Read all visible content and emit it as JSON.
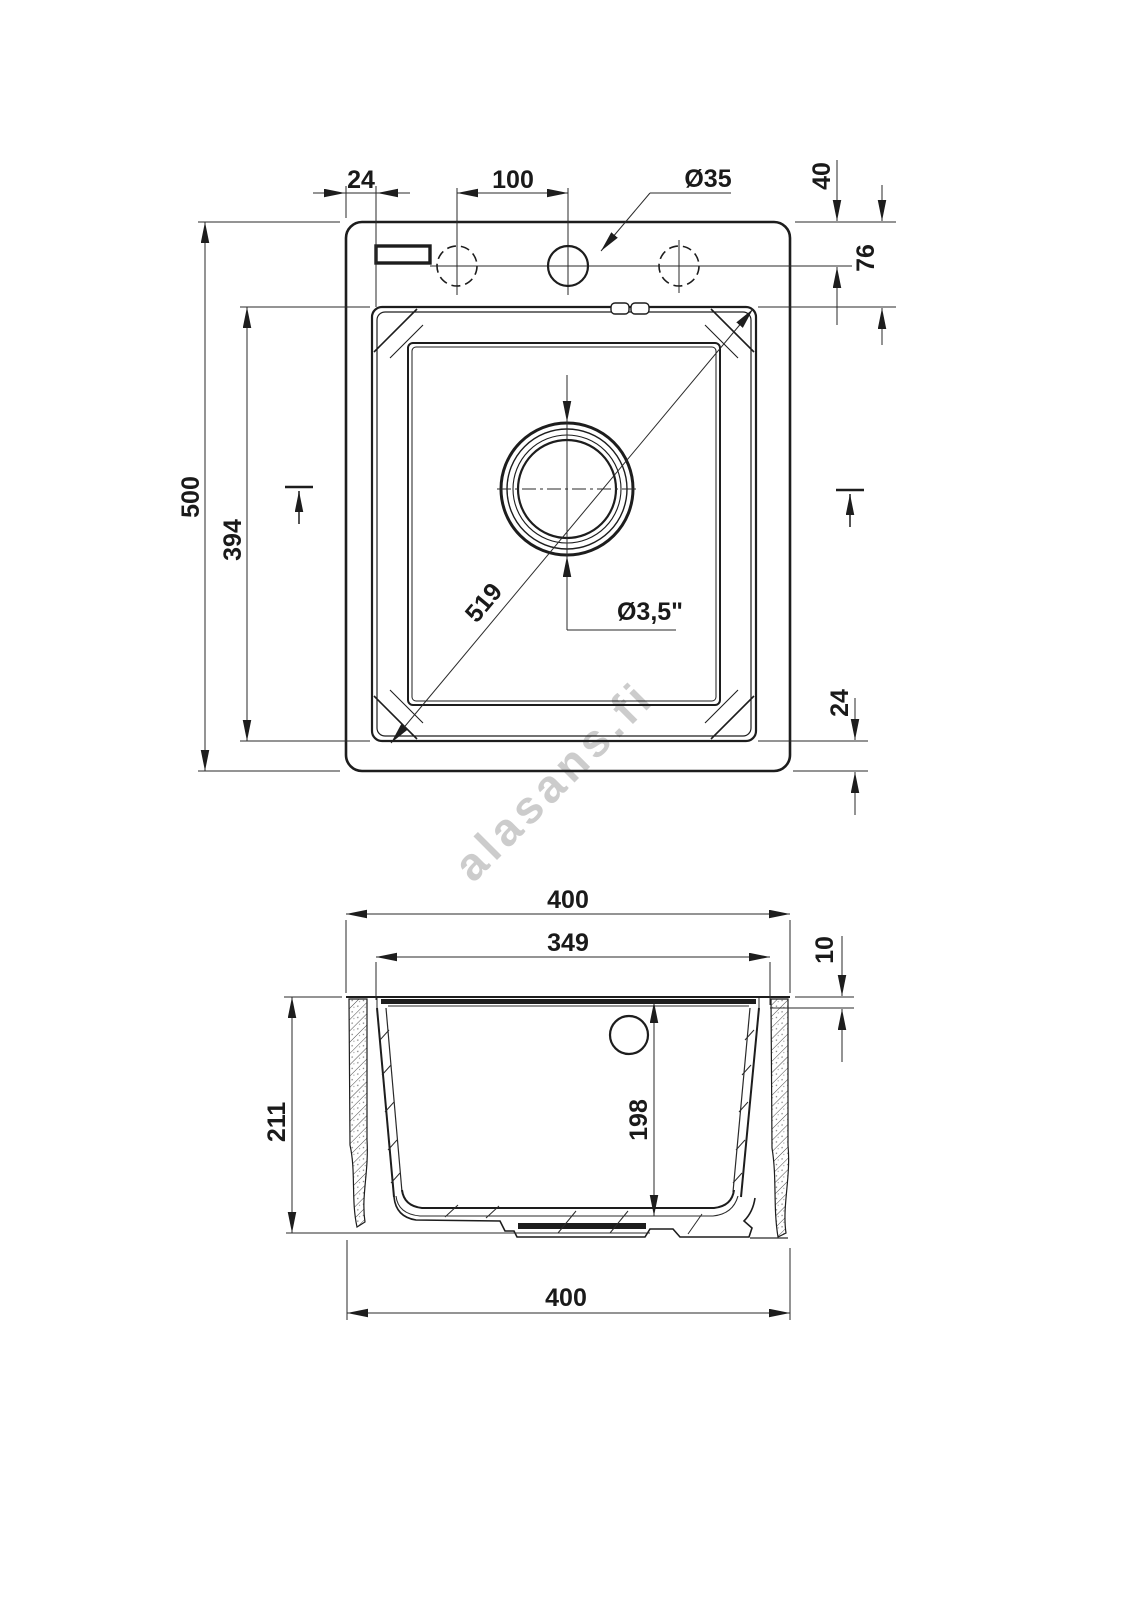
{
  "watermark": {
    "text": "alasans.fi",
    "color": "#c4c4c4"
  },
  "drawing": {
    "type": "technical-drawing",
    "subject": "single-bowl kitchen sink, plan view and cross-section",
    "units": "mm",
    "top_view": {
      "labels": {
        "rim_offset_left": "24",
        "hole_spacing": "100",
        "faucet_hole_diameter": "Ø35",
        "hole_offset_from_top": "40",
        "deck_depth_to_bowl": "76",
        "overall_length": "500",
        "bowl_length": "394",
        "bowl_diagonal": "519",
        "drain_diameter": "Ø3,5\"",
        "rim_offset_bottom": "24"
      }
    },
    "section_view": {
      "labels": {
        "overall_width_top": "400",
        "bowl_width": "349",
        "rim_lip_height": "10",
        "overall_depth": "211",
        "bowl_depth": "198",
        "overall_width_bottom": "400"
      }
    }
  }
}
